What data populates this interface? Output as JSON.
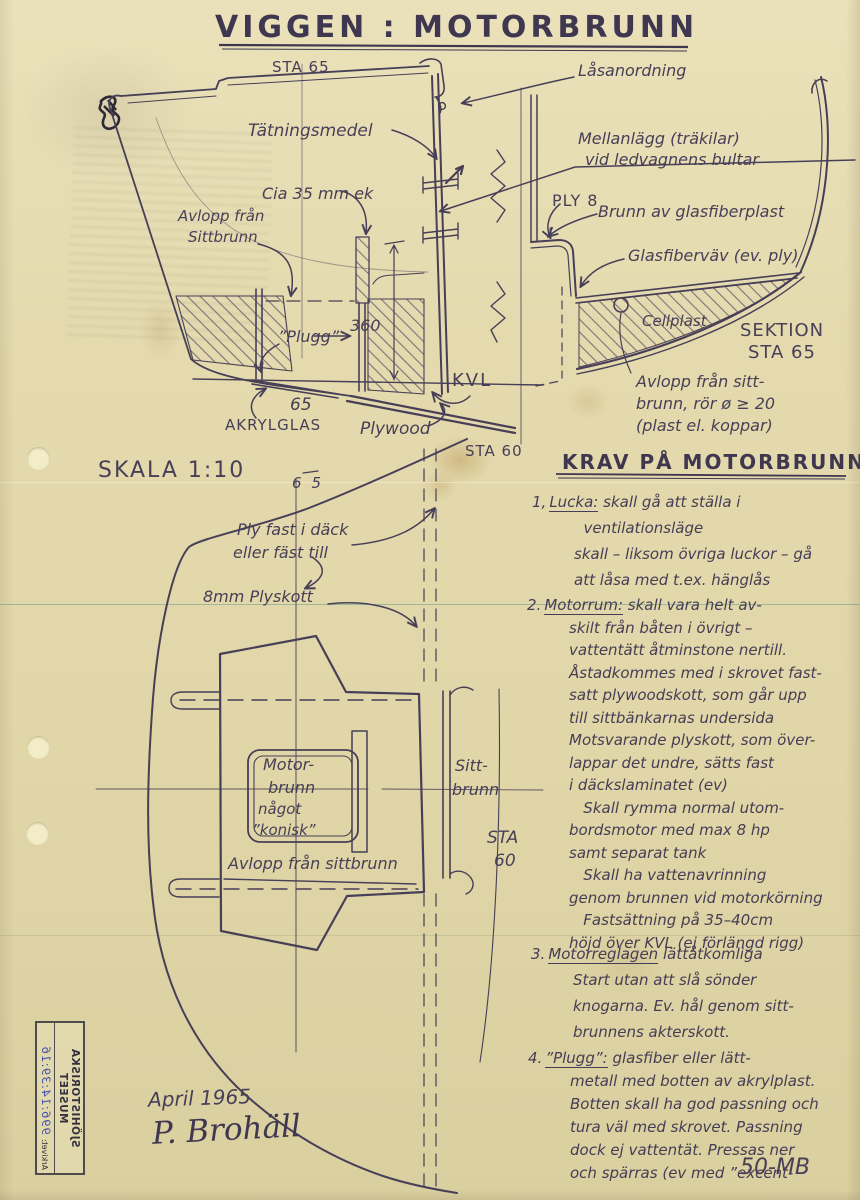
{
  "colors": {
    "paper": "#e4daae",
    "ink": "#473f57",
    "stamp_blue": "#4553ae"
  },
  "title": "VIGGEN : MOTORBRUNN",
  "section_drawing": {
    "sta65_top": "STA 65",
    "lasanordning": "Låsanordning",
    "tatningsmedel": "Tätningsmedel",
    "mellanlagg_1": "Mellanlägg (träkilar)",
    "mellanlagg_2": "vid ledvagnens bultar",
    "cia": "Cia 35 mm ek",
    "avlopp_1": "Avlopp från",
    "avlopp_2": "Sittbrunn",
    "ply8": "PLY 8",
    "brunn": "Brunn av glasfiberplast",
    "glasfibervav": "Glasfiberväv (ev. ply)",
    "cellplast": "Cellplast",
    "sektion_1": "SEKTION",
    "sektion_2": "STA 65",
    "plugg": "”Plugg”",
    "dim_360": "360",
    "kvl": "KVL",
    "dim_65": "65",
    "akrylglas": "AKRYLGLAS",
    "plywood": "Plywood",
    "sta60": "STA 60",
    "avlopp_ror_1": "Avlopp från sitt-",
    "avlopp_ror_2": "brunn, rör ø ≥ 20",
    "avlopp_ror_3": "(plast el. koppar)"
  },
  "plan_drawing": {
    "skala": "SKALA 1:10",
    "sta65_mark": "65",
    "ply_fast_1": "Ply fast i däck",
    "ply_fast_2": "eller fäst till",
    "plyskott": "8mm Plyskott",
    "motorbrunn_1": "Motor-",
    "motorbrunn_2": "brunn",
    "motorbrunn_3": "något",
    "motorbrunn_4": "”konisk”",
    "sittbrunn_1": "Sitt-",
    "sittbrunn_2": "brunn",
    "sta60_1": "STA",
    "sta60_2": "60",
    "avlopp": "Avlopp från sittbrunn"
  },
  "requirements": {
    "heading": "KRAV PÅ MOTORBRUNN",
    "items": [
      {
        "num": "1,",
        "keyword": "Lucka:",
        "first_rest": " skall gå att ställa i",
        "lines": [
          "  ventilationsläge",
          "skall – liksom övriga luckor – gå",
          "att låsa med t.ex. hänglås"
        ]
      },
      {
        "num": "2.",
        "keyword": "Motorrum:",
        "first_rest": " skall vara helt av-",
        "lines": [
          "skilt från båten i övrigt –",
          "vattentätt åtminstone nertill.",
          "Åstadkommes med i skrovet fast-",
          "satt plywoodskott, som går upp",
          "till sittbänkarnas undersida",
          "Motsvarande plyskott, som över-",
          "lappar det undre, sätts fast",
          "i däckslaminatet (ev)",
          "   Skall rymma normal utom-",
          "bordsmotor med max 8 hp",
          "samt separat tank",
          "   Skall ha vattenavrinning",
          "genom brunnen vid motorkörning",
          "   Fastsättning på 35–40cm",
          "höjd över KVL (ej förlängd rigg)"
        ]
      },
      {
        "num": "3.",
        "keyword": "Motorreglagen",
        "first_rest": " lättåtkomliga",
        "lines": [
          "Start utan att slå sönder",
          "knogarna. Ev. hål genom sitt-",
          "brunnens akterskott."
        ]
      },
      {
        "num": "4.",
        "keyword": "”Plugg”:",
        "first_rest": " glasfiber eller lätt-",
        "lines": [
          "metall med botten av akrylplast.",
          "Botten skall ha god passning och",
          "tura väl med skrovet. Passning",
          "dock ej vattentät. Pressas ner",
          "och spärras (ev med ”excent-"
        ]
      }
    ]
  },
  "footer": {
    "date": "April 1965",
    "signature": "P. Brohäll",
    "code": "50-MB"
  },
  "stamp": {
    "museum": "SJÖHISTORISKA MUSEET",
    "archive_label": "Arkivet:",
    "number": "996:14:39:16"
  }
}
